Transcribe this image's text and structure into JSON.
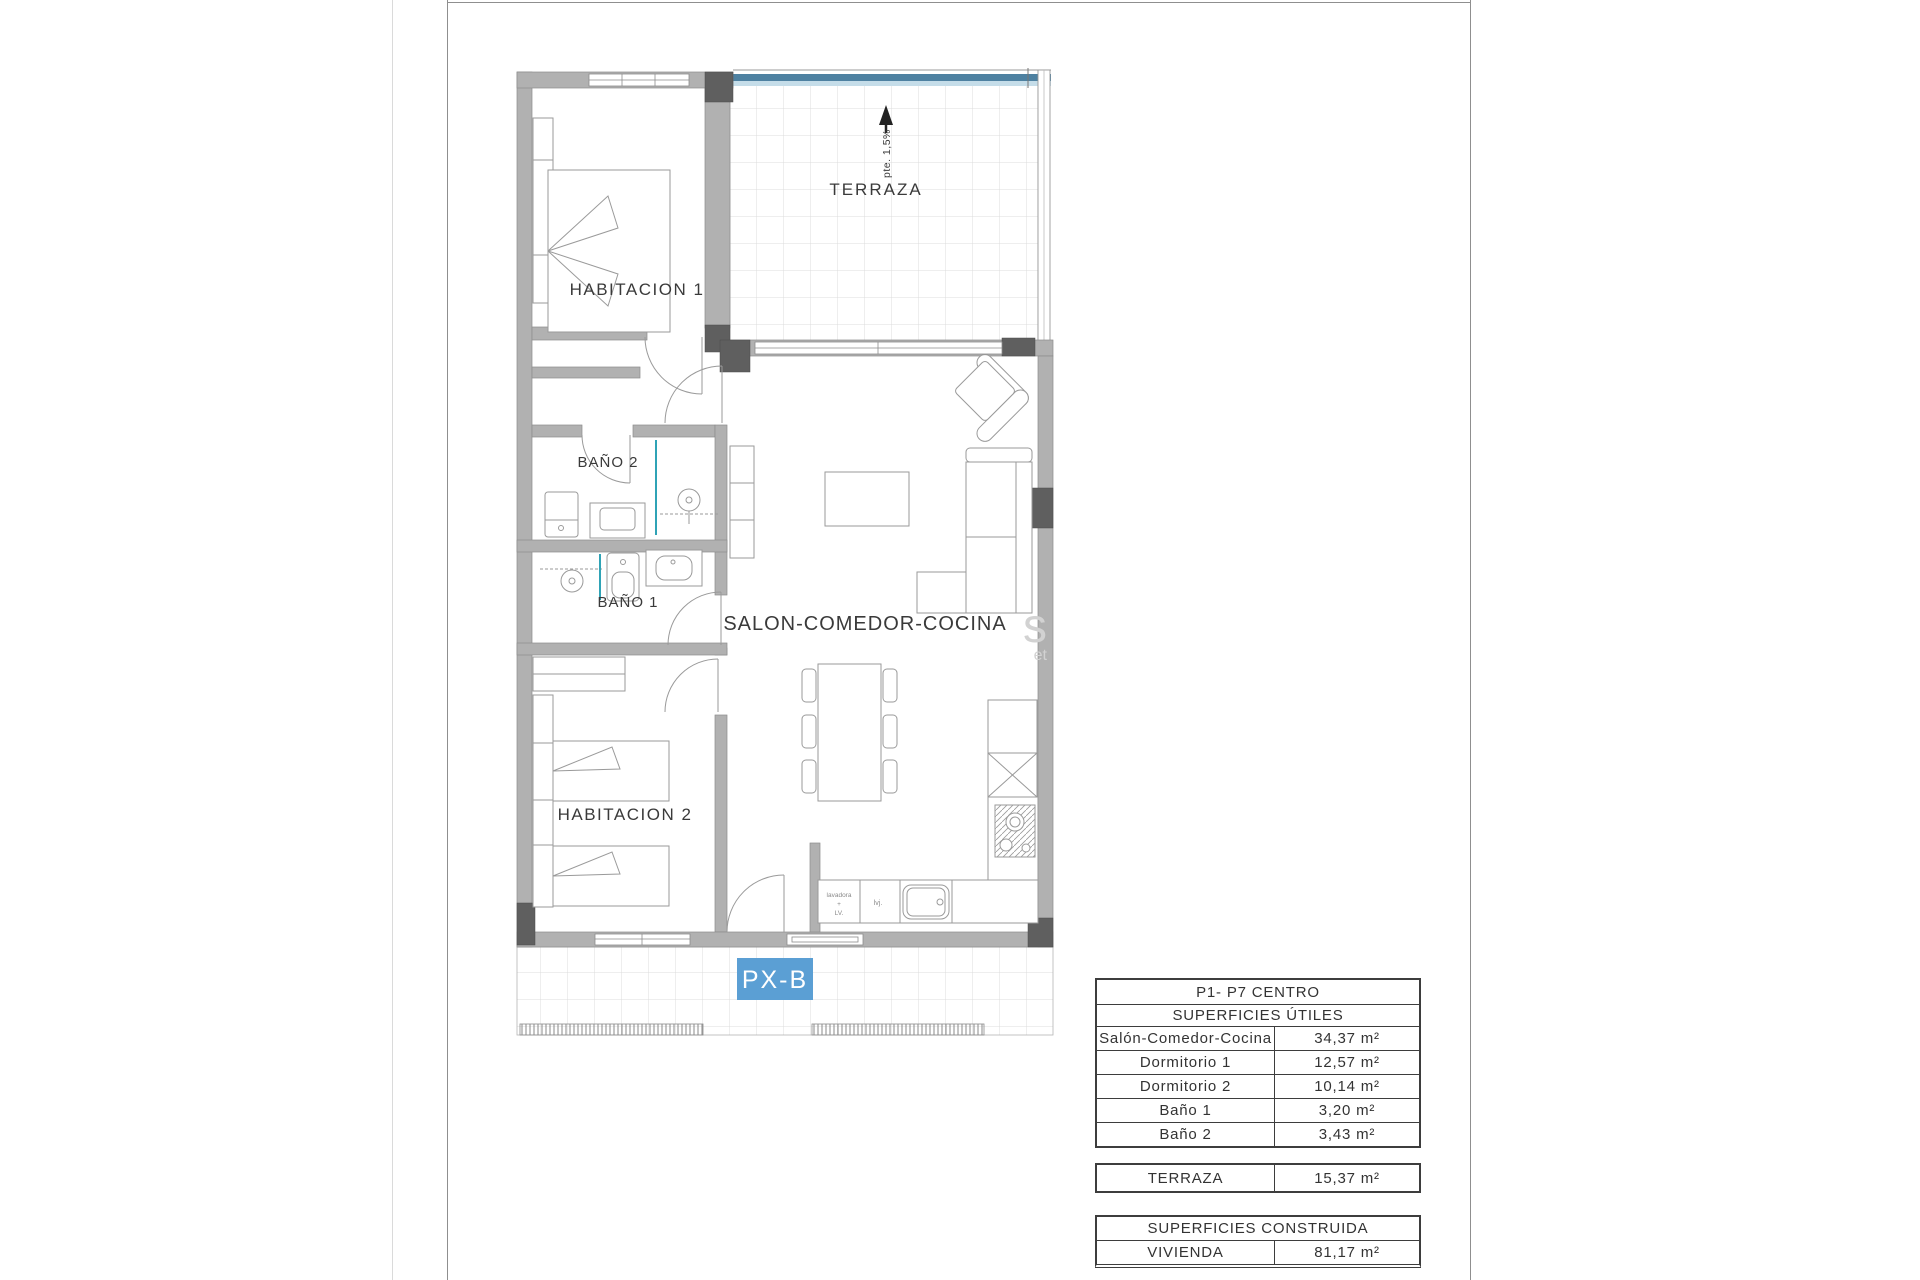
{
  "plan": {
    "rooms": {
      "habitacion1": "HABITACION 1",
      "habitacion2": "HABITACION 2",
      "bano1": "BAÑO 1",
      "bano2": "BAÑO 2",
      "salon": "SALON-COMEDOR-COCINA",
      "terraza": "TERRAZA"
    },
    "terraza_slope": "pte. 1,5%",
    "unit_label": "PX-B",
    "kitchen_labels": {
      "washer_line1": "lavadora",
      "washer_line2": "+",
      "washer_line3": "LV.",
      "dishwasher": "lvj."
    },
    "watermark": {
      "large": "s",
      "small": "et"
    }
  },
  "tables": {
    "utiles": {
      "title": "P1- P7 CENTRO",
      "subtitle": "SUPERFICIES ÚTILES",
      "rows": [
        {
          "label": "Salón-Comedor-Cocina",
          "value": "34,37 m²"
        },
        {
          "label": "Dormitorio 1",
          "value": "12,57 m²"
        },
        {
          "label": "Dormitorio 2",
          "value": "10,14 m²"
        },
        {
          "label": "Baño 1",
          "value": "3,20 m²"
        },
        {
          "label": "Baño 2",
          "value": "3,43 m²"
        }
      ]
    },
    "terraza": {
      "label": "TERRAZA",
      "value": "15,37 m²"
    },
    "construida": {
      "title": "SUPERFICIES CONSTRUIDA",
      "rows": [
        {
          "label": "VIVIENDA",
          "value": "81,17 m²"
        }
      ]
    }
  },
  "colors": {
    "accent_blue": "#5b9fd4",
    "terrace_edge_blue": "#4e81a1",
    "terrace_edge_blue_light": "#c5dde9",
    "wall_gray": "#b1b1b1",
    "pillar_gray": "#5f5f5f",
    "shower_screen_teal": "#2fa3b6"
  }
}
